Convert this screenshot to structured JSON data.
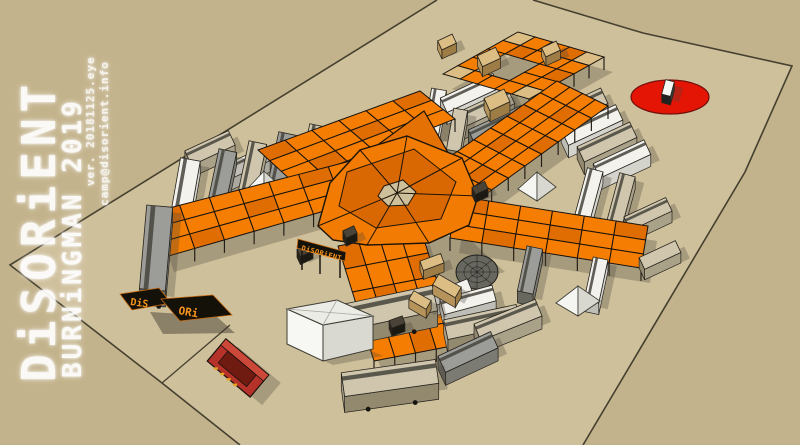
{
  "watermark": {
    "title": "DiSORiENT",
    "subtitle": "BURNiNGMAN 2019",
    "version": "ver. 20181125.eye",
    "email": "camp@disorient.info"
  },
  "signs": {
    "scaffold_sign": "DiSORiENT",
    "fallen_sign_left": "DiS",
    "fallen_sign_right": "ORi"
  },
  "colors": {
    "ground_outside": "#c3b38c",
    "ground_inside": "#cfc09c",
    "edge": "#45402f",
    "orange": "#f47d02",
    "orange_alt": "#e06d02",
    "panel_line": "#17130d",
    "plywood": "#dcbe85",
    "sail": "#f27c03",
    "sail_back": "#e47103",
    "sail_dark": "#d96803",
    "sail_seam": "#1c1408",
    "red_circle": "#e51506",
    "red_circle_edge": "#70100a",
    "couch": "#b5322a",
    "couch_dark": "#701b12",
    "couch_rim": "#cc4838",
    "couch_text": "#e8a41c",
    "sign_bg": "#141109",
    "sign_border": "#c96a10",
    "sign_text": "#f7941d",
    "shadow": "rgba(76,70,56,0.30)",
    "dome": "#67675f",
    "tent_light": "#f5f5f1",
    "tent_shade": "#d8d8d1",
    "tent_edge": "#3c3c33",
    "palettes": {
      "white": {
        "top": "#f3f2ed",
        "side": "#d4d3cc",
        "front": "#bfbeb6",
        "win": true
      },
      "tan": {
        "top": "#cfc6ad",
        "side": "#aaa189",
        "front": "#93896f",
        "win": true
      },
      "gray": {
        "top": "#9c9c98",
        "side": "#7b7b74",
        "front": "#68685f",
        "win": true
      },
      "wood": {
        "top": "#dcbe85",
        "side": "#b6935a",
        "front": "#9d7c45",
        "win": false
      },
      "scaffold": {
        "top": "#4a4337",
        "side": "#27221a",
        "front": "#1c1812",
        "win": false
      },
      "art": {
        "top": "#f6f6f3",
        "side": "#3a3a38",
        "front": "#222220",
        "win": false
      }
    }
  },
  "scene": {
    "plot": [
      [
        437,
        0
      ],
      [
        533,
        0
      ],
      [
        643,
        33
      ],
      [
        792,
        66
      ],
      [
        745,
        172
      ],
      [
        583,
        445
      ],
      [
        240,
        445
      ],
      [
        162,
        383
      ],
      [
        10,
        265
      ]
    ],
    "edge_left": [
      [
        437,
        0
      ],
      [
        10,
        265
      ],
      [
        162,
        383
      ],
      [
        240,
        445
      ]
    ],
    "edge_right": [
      [
        533,
        0
      ],
      [
        643,
        33
      ],
      [
        792,
        66
      ],
      [
        745,
        172
      ],
      [
        583,
        445
      ]
    ],
    "road_line": [
      [
        162,
        383
      ],
      [
        230,
        325
      ]
    ],
    "red_circle": {
      "cx": 670,
      "cy": 97,
      "rx": 39,
      "ry": 17
    },
    "arms": [
      {
        "A": [
          443,
          74
        ],
        "B": [
          518,
          32
        ],
        "C": [
          604,
          57
        ],
        "D": [
          529,
          99
        ],
        "nu": 5,
        "nv": 5,
        "holes": [
          [
            2,
            2
          ],
          [
            1,
            2
          ],
          [
            2,
            1
          ],
          [
            1,
            1
          ]
        ],
        "tan": [
          [
            0,
            4
          ],
          [
            4,
            0
          ],
          [
            0,
            0
          ],
          [
            4,
            4
          ]
        ]
      },
      {
        "A": [
          258,
          150
        ],
        "B": [
          420,
          91
        ],
        "C": [
          455,
          119
        ],
        "D": [
          293,
          182
        ],
        "nu": 6,
        "nv": 3
      },
      {
        "A": [
          424,
          175
        ],
        "B": [
          557,
          81
        ],
        "C": [
          608,
          106
        ],
        "D": [
          475,
          202
        ],
        "nu": 8,
        "nv": 4
      },
      {
        "A": [
          150,
          213
        ],
        "B": [
          358,
          159
        ],
        "C": [
          373,
          197
        ],
        "D": [
          165,
          257
        ],
        "nu": 7,
        "nv": 3
      },
      {
        "A": [
          457,
          196
        ],
        "B": [
          648,
          226
        ],
        "C": [
          641,
          268
        ],
        "D": [
          450,
          238
        ],
        "nu": 6,
        "nv": 3
      },
      {
        "A": [
          338,
          246
        ],
        "B": [
          421,
          230
        ],
        "C": [
          457,
          345
        ],
        "D": [
          374,
          361
        ],
        "nu": 4,
        "nv": 5
      }
    ],
    "sail": {
      "shadow": [
        [
          352,
          226
        ],
        [
          468,
          238
        ],
        [
          505,
          272
        ],
        [
          430,
          292
        ],
        [
          352,
          266
        ]
      ],
      "back": [
        [
          368,
          152
        ],
        [
          424,
          111
        ],
        [
          457,
          168
        ]
      ],
      "outer": [
        [
          318,
          226
        ],
        [
          330,
          183
        ],
        [
          360,
          150
        ],
        [
          407,
          136
        ],
        [
          462,
          158
        ],
        [
          478,
          196
        ],
        [
          469,
          225
        ],
        [
          429,
          243
        ],
        [
          367,
          245
        ],
        [
          333,
          240
        ]
      ],
      "inner": [
        [
          347,
          172
        ],
        [
          414,
          149
        ],
        [
          456,
          182
        ],
        [
          441,
          219
        ],
        [
          376,
          228
        ],
        [
          339,
          206
        ]
      ],
      "hole": [
        [
          384,
          186
        ],
        [
          403,
          180
        ],
        [
          416,
          192
        ],
        [
          408,
          205
        ],
        [
          388,
          206
        ],
        [
          378,
          196
        ]
      ],
      "center": [
        397,
        193
      ],
      "seam_targets": [
        [
          318,
          226
        ],
        [
          360,
          150
        ],
        [
          407,
          136
        ],
        [
          462,
          158
        ],
        [
          478,
          196
        ],
        [
          429,
          243
        ],
        [
          367,
          245
        ]
      ]
    },
    "vehicles_back": [
      {
        "x": 668,
        "y": 88,
        "l": 15,
        "w": 9,
        "a": -75,
        "p": "art"
      },
      {
        "x": 210,
        "y": 148,
        "l": 48,
        "w": 16,
        "a": -25,
        "p": "tan"
      },
      {
        "x": 247,
        "y": 163,
        "l": 44,
        "w": 15,
        "a": -25,
        "p": "white"
      },
      {
        "x": 313,
        "y": 152,
        "l": 54,
        "w": 18,
        "a": -78,
        "p": "tan"
      },
      {
        "x": 282,
        "y": 160,
        "l": 54,
        "w": 18,
        "a": -78,
        "p": "gray"
      },
      {
        "x": 252,
        "y": 170,
        "l": 56,
        "w": 18,
        "a": -78,
        "p": "tan"
      },
      {
        "x": 222,
        "y": 178,
        "l": 56,
        "w": 18,
        "a": -78,
        "p": "gray"
      },
      {
        "x": 185,
        "y": 190,
        "l": 62,
        "w": 20,
        "a": -80,
        "p": "white"
      },
      {
        "x": 435,
        "y": 112,
        "l": 46,
        "w": 15,
        "a": -80,
        "p": "white"
      },
      {
        "x": 470,
        "y": 93,
        "l": 58,
        "w": 16,
        "a": -25,
        "p": "white"
      },
      {
        "x": 484,
        "y": 109,
        "l": 60,
        "w": 16,
        "a": -25,
        "p": "tan"
      },
      {
        "x": 457,
        "y": 130,
        "l": 42,
        "w": 14,
        "a": -80,
        "p": "tan"
      },
      {
        "x": 498,
        "y": 125,
        "l": 58,
        "w": 16,
        "a": -25,
        "p": "gray"
      },
      {
        "x": 578,
        "y": 108,
        "l": 58,
        "w": 17,
        "a": -25,
        "p": "tan"
      },
      {
        "x": 592,
        "y": 125,
        "l": 60,
        "w": 17,
        "a": -25,
        "p": "white"
      },
      {
        "x": 607,
        "y": 142,
        "l": 58,
        "w": 17,
        "a": -25,
        "p": "tan"
      },
      {
        "x": 622,
        "y": 159,
        "l": 56,
        "w": 16,
        "a": -25,
        "p": "white"
      },
      {
        "x": 589,
        "y": 193,
        "l": 48,
        "w": 16,
        "a": -75,
        "p": "white"
      },
      {
        "x": 621,
        "y": 199,
        "l": 50,
        "w": 16,
        "a": -75,
        "p": "tan"
      },
      {
        "x": 648,
        "y": 214,
        "l": 46,
        "w": 15,
        "a": -25,
        "p": "tan"
      },
      {
        "x": 612,
        "y": 238,
        "l": 42,
        "w": 14,
        "a": -25,
        "p": "gray"
      }
    ],
    "vehicles_front": [
      {
        "x": 156,
        "y": 248,
        "l": 84,
        "w": 26,
        "a": -85,
        "p": "gray"
      },
      {
        "x": 530,
        "y": 270,
        "l": 46,
        "w": 16,
        "a": -78,
        "p": "gray"
      },
      {
        "x": 596,
        "y": 280,
        "l": 44,
        "w": 15,
        "a": -78,
        "p": "white"
      },
      {
        "x": 452,
        "y": 292,
        "l": 38,
        "w": 13,
        "a": -22,
        "p": "white"
      },
      {
        "x": 468,
        "y": 300,
        "l": 54,
        "w": 16,
        "a": -15,
        "p": "white"
      },
      {
        "x": 482,
        "y": 322,
        "l": 74,
        "w": 20,
        "a": -12,
        "p": "tan"
      },
      {
        "x": 508,
        "y": 320,
        "l": 66,
        "w": 18,
        "a": -22,
        "p": "tan"
      },
      {
        "x": 388,
        "y": 308,
        "l": 96,
        "w": 26,
        "a": -12,
        "p": "tan"
      },
      {
        "x": 468,
        "y": 352,
        "l": 58,
        "w": 18,
        "a": -25,
        "p": "gray"
      },
      {
        "x": 390,
        "y": 378,
        "l": 95,
        "w": 24,
        "a": -8,
        "p": "tan"
      },
      {
        "x": 660,
        "y": 255,
        "l": 40,
        "w": 13,
        "a": -25,
        "p": "tan"
      },
      {
        "x": 489,
        "y": 57,
        "l": 20,
        "w": 12,
        "a": -25,
        "p": "wood"
      },
      {
        "x": 447,
        "y": 42,
        "l": 16,
        "w": 10,
        "a": -25,
        "p": "wood"
      },
      {
        "x": 551,
        "y": 49,
        "l": 16,
        "w": 10,
        "a": -25,
        "p": "wood"
      },
      {
        "x": 497,
        "y": 100,
        "l": 22,
        "w": 14,
        "a": -25,
        "p": "wood"
      },
      {
        "x": 432,
        "y": 262,
        "l": 22,
        "w": 10,
        "a": -20,
        "p": "wood"
      },
      {
        "x": 447,
        "y": 286,
        "l": 26,
        "w": 12,
        "a": 30,
        "p": "wood"
      },
      {
        "x": 420,
        "y": 300,
        "l": 20,
        "w": 10,
        "a": 30,
        "p": "wood"
      },
      {
        "x": 305,
        "y": 250,
        "l": 14,
        "w": 8,
        "a": -25,
        "p": "scaffold"
      },
      {
        "x": 350,
        "y": 232,
        "l": 12,
        "w": 8,
        "a": -25,
        "p": "scaffold"
      },
      {
        "x": 480,
        "y": 188,
        "l": 14,
        "w": 8,
        "a": -25,
        "p": "scaffold"
      },
      {
        "x": 397,
        "y": 322,
        "l": 14,
        "w": 8,
        "a": -20,
        "p": "scaffold"
      }
    ],
    "dome": {
      "cx": 477,
      "cy": 272,
      "rx": 21,
      "ry": 17
    },
    "tents": [
      {
        "apex": [
          264,
          171
        ],
        "base": [
          [
            249,
            187
          ],
          [
            264,
            197
          ],
          [
            279,
            185
          ],
          [
            264,
            177
          ]
        ],
        "layer": "back"
      },
      {
        "apex": [
          537,
          172
        ],
        "base": [
          [
            518,
            189
          ],
          [
            537,
            201
          ],
          [
            556,
            187
          ],
          [
            537,
            179
          ]
        ],
        "layer": "back"
      },
      {
        "apex": [
          578,
          286
        ],
        "base": [
          [
            556,
            303
          ],
          [
            578,
            316
          ],
          [
            600,
            301
          ],
          [
            578,
            293
          ]
        ],
        "layer": "front"
      }
    ],
    "pavilion": {
      "top": [
        [
          287,
          309
        ],
        [
          337,
          300
        ],
        [
          373,
          316
        ],
        [
          323,
          325
        ]
      ],
      "left": [
        [
          287,
          309
        ],
        [
          323,
          325
        ],
        [
          323,
          361
        ],
        [
          287,
          344
        ]
      ],
      "right": [
        [
          323,
          325
        ],
        [
          373,
          316
        ],
        [
          373,
          349
        ],
        [
          323,
          361
        ]
      ]
    },
    "couch": {
      "cx": 238,
      "cy": 368,
      "a": 40,
      "l": 56,
      "w": 29
    },
    "scaffold_sign_band": [
      [
        298,
        239
      ],
      [
        346,
        252
      ],
      [
        345,
        261
      ],
      [
        297,
        248
      ]
    ],
    "scaffold_sign_legs": [
      [
        [
          302,
          250
        ],
        [
          302,
          270
        ]
      ],
      [
        [
          320,
          255
        ],
        [
          320,
          274
        ]
      ],
      [
        [
          340,
          260
        ],
        [
          340,
          278
        ]
      ]
    ],
    "fallen_panels": [
      [
        [
          120,
          294
        ],
        [
          159,
          288
        ],
        [
          171,
          303
        ],
        [
          132,
          310
        ]
      ],
      [
        [
          161,
          299
        ],
        [
          213,
          295
        ],
        [
          232,
          315
        ],
        [
          180,
          321
        ]
      ]
    ],
    "fallen_shadow": [
      [
        150,
        312
      ],
      [
        216,
        316
      ],
      [
        235,
        333
      ],
      [
        163,
        334
      ]
    ]
  }
}
